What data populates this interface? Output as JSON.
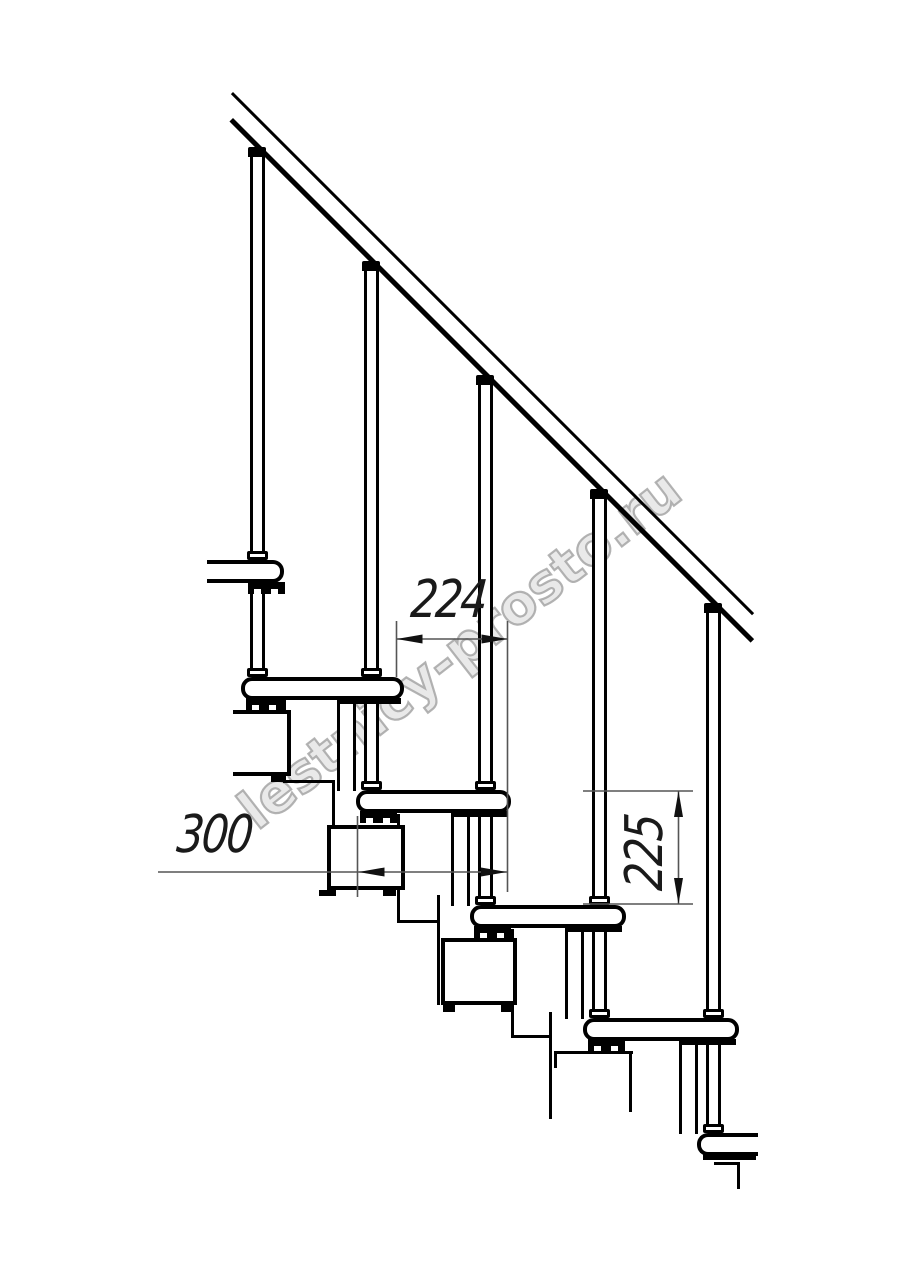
{
  "drawing": {
    "watermark": "lestnicy-prosto.ru",
    "dims": [
      {
        "value": "224",
        "orientation": "horizontal"
      },
      {
        "value": "300",
        "orientation": "horizontal"
      },
      {
        "value": "225",
        "orientation": "vertical"
      }
    ]
  }
}
